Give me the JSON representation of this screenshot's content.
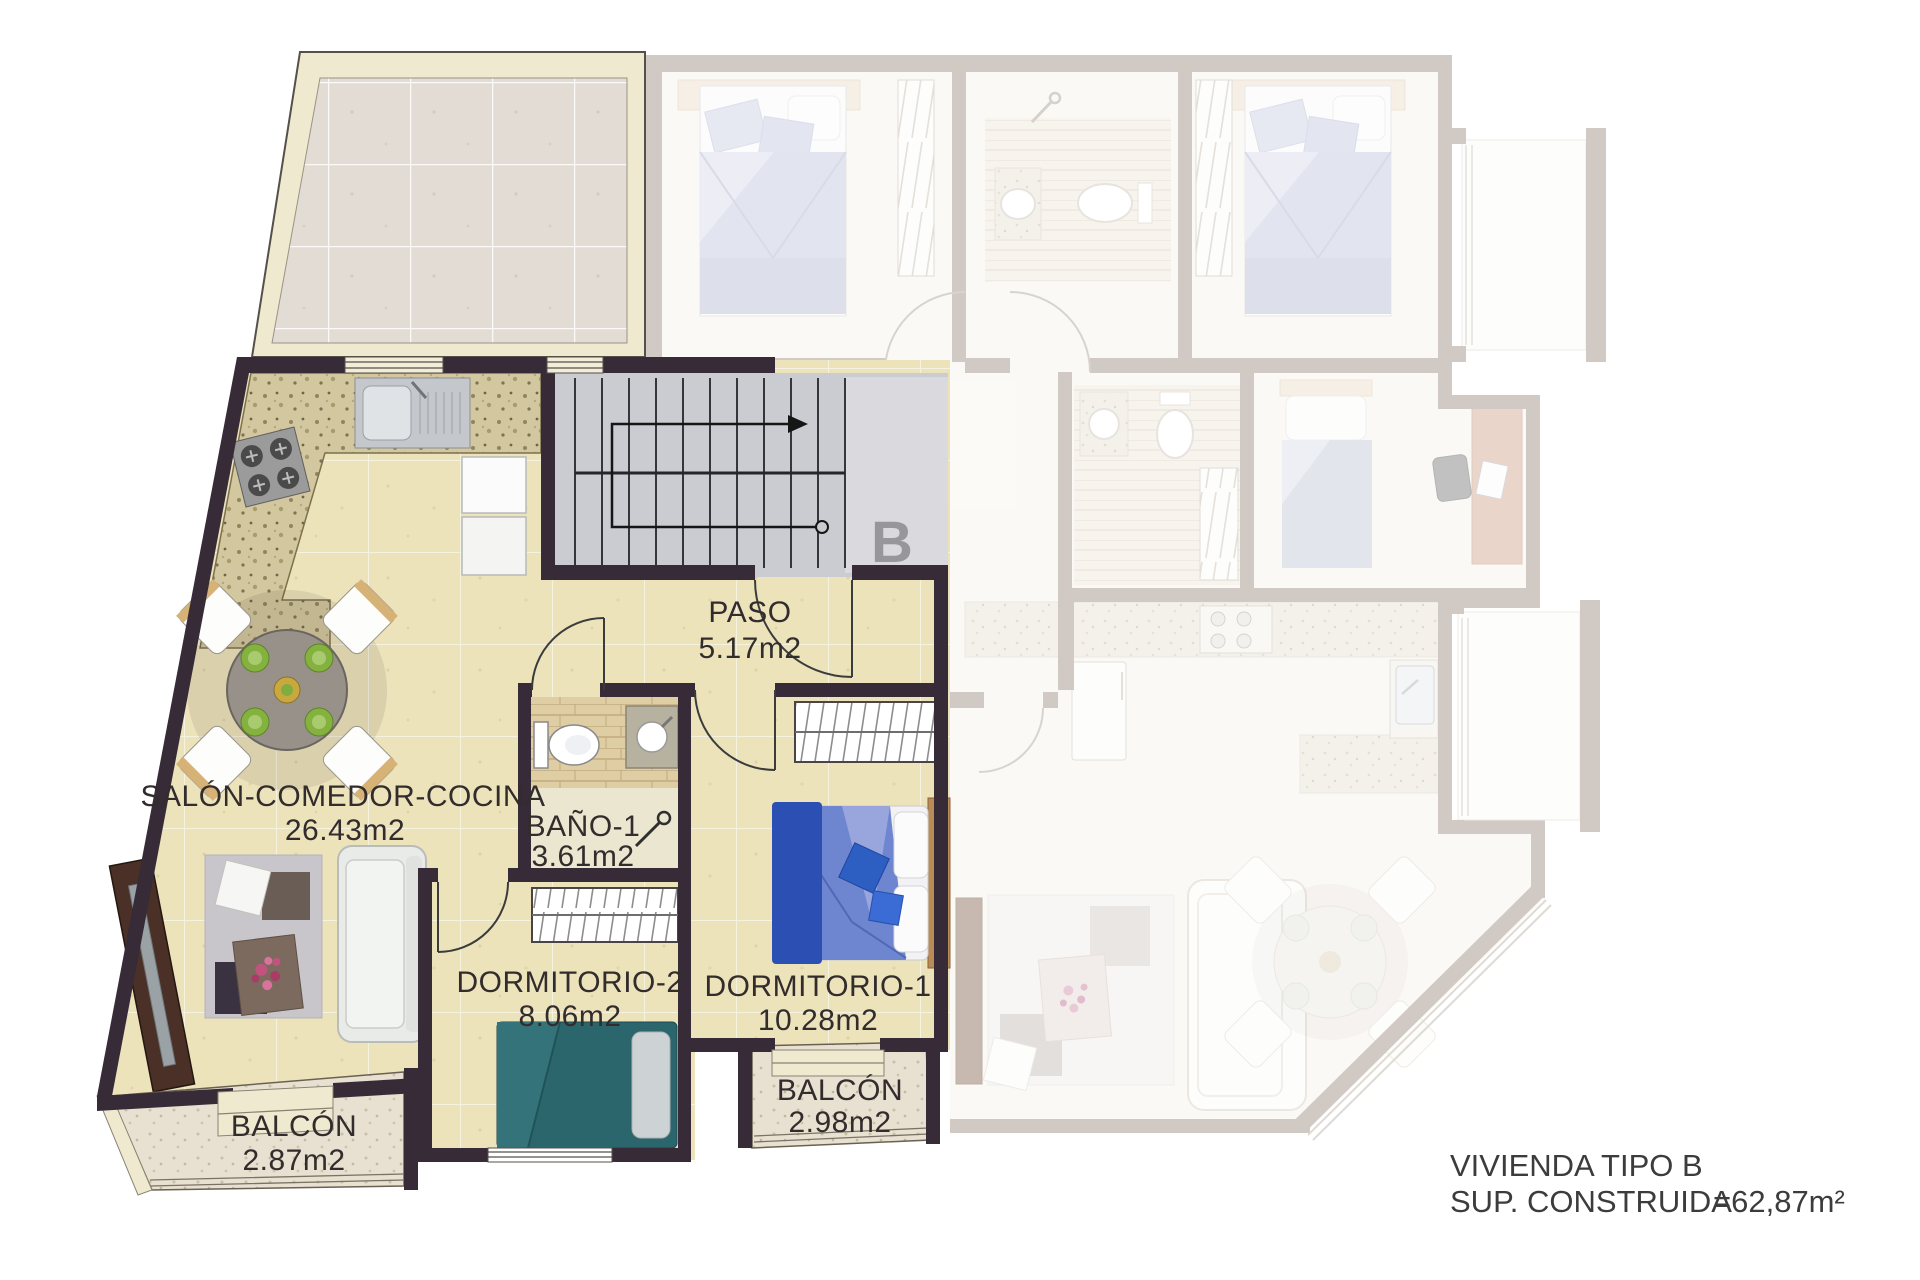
{
  "palette": {
    "active_wall": "#362b36",
    "floor_tile": "#ece3bb",
    "terrace_tile": "#e2dcd4",
    "trim_cream": "#eee9cf",
    "stair_gray": "#cbccd1",
    "ghost_wall": "#aca095",
    "ghost_floor": "#f9f5ee",
    "bed_blue": "#5b79c4",
    "bed_teal": "#2a666c",
    "label_ink": "#322c2c"
  },
  "stairs": {
    "letter": "B"
  },
  "rooms": {
    "salon": {
      "name": "SALÓN-COMEDOR-COCINA",
      "area": "26.43m2"
    },
    "paso": {
      "name": "PASO",
      "area": "5.17m2"
    },
    "bano1": {
      "name": "BAÑO-1",
      "area": "3.61m2"
    },
    "dormitorio2": {
      "name": "DORMITORIO-2",
      "area": "8.06m2"
    },
    "dormitorio1": {
      "name": "DORMITORIO-1",
      "area": "10.28m2"
    },
    "balcon_salon": {
      "name": "BALCÓN",
      "area": "2.87m2"
    },
    "balcon_dormitorio": {
      "name": "BALCÓN",
      "area": "2.98m2"
    }
  },
  "title_block": {
    "line1": "VIVIENDA TIPO B",
    "line2_label": "SUP. CONSTRUIDA",
    "line2_value": "=62,87m²"
  }
}
